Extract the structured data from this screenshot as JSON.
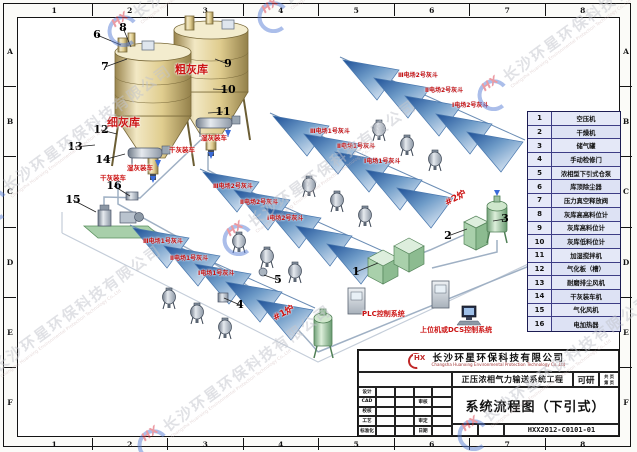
{
  "frame": {
    "top_zones": [
      "1",
      "2",
      "3",
      "4",
      "5",
      "6",
      "7",
      "8"
    ],
    "bottom_zones": [
      "1",
      "2",
      "3",
      "4",
      "5",
      "6",
      "7",
      "8"
    ],
    "left_zones": [
      "A",
      "B",
      "C",
      "D",
      "E",
      "F"
    ],
    "right_zones": [
      "A",
      "B",
      "C",
      "D",
      "E",
      "F"
    ]
  },
  "legend": {
    "rows": [
      {
        "no": "1",
        "name": "空压机"
      },
      {
        "no": "2",
        "name": "干燥机"
      },
      {
        "no": "3",
        "name": "储气罐"
      },
      {
        "no": "4",
        "name": "手动检修门"
      },
      {
        "no": "5",
        "name": "浓相型下引式仓泵"
      },
      {
        "no": "6",
        "name": "库顶除尘器"
      },
      {
        "no": "7",
        "name": "压力真空释放阀"
      },
      {
        "no": "8",
        "name": "灰库高高料位计"
      },
      {
        "no": "9",
        "name": "灰库高料位计"
      },
      {
        "no": "10",
        "name": "灰库低料位计"
      },
      {
        "no": "11",
        "name": "加湿搅拌机"
      },
      {
        "no": "12",
        "name": "气化板（槽）"
      },
      {
        "no": "13",
        "name": "耐磨排尘风机"
      },
      {
        "no": "14",
        "name": "干灰装车机"
      },
      {
        "no": "15",
        "name": "气化风机"
      },
      {
        "no": "16",
        "name": "电加热器"
      }
    ]
  },
  "title_block": {
    "logo_text": "HX",
    "company_cn": "长沙环星环保科技有限公司",
    "company_en": "Changsha Huanxing Environmental Protection Technology Co.,Ltd",
    "project": "正压浓相气力输送系统工程",
    "stage": "可研",
    "pages_total_label": "共  页",
    "pages_no_label": "第  页",
    "drawing_title": "系统流程图（下引式）",
    "drawing_no": "HXX2012-C0101-01",
    "fields_left": [
      "设计",
      "CAD",
      "校核",
      "工艺",
      "标准化"
    ],
    "fields_mid": [
      "",
      "审核",
      "",
      "审定",
      "日期"
    ]
  },
  "diagram": {
    "red_labels": [
      {
        "text": "细灰库",
        "x": 107,
        "y": 114,
        "size": 11,
        "rot": 0
      },
      {
        "text": "粗灰库",
        "x": 175,
        "y": 61,
        "size": 11,
        "rot": 0
      },
      {
        "text": "湿灰装车",
        "x": 201,
        "y": 132,
        "size": 6.5,
        "rot": 0
      },
      {
        "text": "干灰装车",
        "x": 169,
        "y": 144,
        "size": 6.5,
        "rot": 0
      },
      {
        "text": "湿灰装车",
        "x": 127,
        "y": 162,
        "size": 6.5,
        "rot": 0
      },
      {
        "text": "干灰装车",
        "x": 100,
        "y": 172,
        "size": 6.5,
        "rot": 0
      },
      {
        "text": "#1炉",
        "x": 270,
        "y": 312,
        "size": 9,
        "rot": -28
      },
      {
        "text": "#2炉",
        "x": 442,
        "y": 197,
        "size": 9,
        "rot": -28
      },
      {
        "text": "PLC控制系统",
        "x": 362,
        "y": 309,
        "size": 7,
        "rot": 0
      },
      {
        "text": "上位机或DCS控制系统",
        "x": 420,
        "y": 325,
        "size": 7,
        "rot": 0
      }
    ],
    "hopper_labels": [
      {
        "text": "Ⅲ电场1号灰斗",
        "x": 143,
        "y": 236
      },
      {
        "text": "Ⅱ电场1号灰斗",
        "x": 170,
        "y": 253
      },
      {
        "text": "Ⅰ电场1号灰斗",
        "x": 198,
        "y": 268
      },
      {
        "text": "Ⅲ电场2号灰斗",
        "x": 213,
        "y": 181
      },
      {
        "text": "Ⅱ电场2号灰斗",
        "x": 240,
        "y": 197
      },
      {
        "text": "Ⅰ电场2号灰斗",
        "x": 267,
        "y": 213
      },
      {
        "text": "Ⅲ电场1号灰斗",
        "x": 310,
        "y": 126
      },
      {
        "text": "Ⅱ电场1号灰斗",
        "x": 337,
        "y": 141
      },
      {
        "text": "Ⅰ电场1号灰斗",
        "x": 364,
        "y": 156
      },
      {
        "text": "Ⅲ电场2号灰斗",
        "x": 398,
        "y": 70
      },
      {
        "text": "Ⅱ电场2号灰斗",
        "x": 425,
        "y": 85
      },
      {
        "text": "Ⅰ电场2号灰斗",
        "x": 452,
        "y": 100
      }
    ],
    "callouts": [
      {
        "no": "1",
        "x": 356,
        "y": 272,
        "tx": 378,
        "ty": 263
      },
      {
        "no": "2",
        "x": 448,
        "y": 236,
        "tx": 467,
        "ty": 229
      },
      {
        "no": "3",
        "x": 505,
        "y": 219,
        "tx": 493,
        "ty": 221
      },
      {
        "no": "4",
        "x": 240,
        "y": 305,
        "tx": 224,
        "ty": 298
      },
      {
        "no": "5",
        "x": 278,
        "y": 280,
        "tx": 264,
        "ty": 275
      },
      {
        "no": "6",
        "x": 97,
        "y": 35,
        "tx": 121,
        "ty": 45
      },
      {
        "no": "7",
        "x": 105,
        "y": 67,
        "tx": 127,
        "ty": 59
      },
      {
        "no": "8",
        "x": 123,
        "y": 28,
        "tx": 131,
        "ty": 47
      },
      {
        "no": "9",
        "x": 228,
        "y": 64,
        "tx": 215,
        "ty": 59
      },
      {
        "no": "10",
        "x": 228,
        "y": 90,
        "tx": 213,
        "ty": 89
      },
      {
        "no": "11",
        "x": 223,
        "y": 112,
        "tx": 208,
        "ty": 113
      },
      {
        "no": "12",
        "x": 101,
        "y": 130,
        "tx": 117,
        "ty": 134
      },
      {
        "no": "13",
        "x": 75,
        "y": 147,
        "tx": 95,
        "ty": 145
      },
      {
        "no": "14",
        "x": 103,
        "y": 160,
        "tx": 125,
        "ty": 154
      },
      {
        "no": "15",
        "x": 73,
        "y": 200,
        "tx": 96,
        "ty": 212
      },
      {
        "no": "16",
        "x": 114,
        "y": 186,
        "tx": 130,
        "ty": 196
      }
    ]
  },
  "watermark": {
    "logo": "HX",
    "cn": "长沙环星环保科技有限公司",
    "en": "Changsha Huanxing Environmental Protection Technology Co.,Ltd",
    "instances": [
      {
        "x": 100,
        "y": 26,
        "rot": -36
      },
      {
        "x": 250,
        "y": 12,
        "rot": -36
      },
      {
        "x": -30,
        "y": 200,
        "rot": -36
      },
      {
        "x": 215,
        "y": 235,
        "rot": -36
      },
      {
        "x": 470,
        "y": 90,
        "rot": -36
      },
      {
        "x": -40,
        "y": 380,
        "rot": -36
      },
      {
        "x": 130,
        "y": 440,
        "rot": -36
      },
      {
        "x": 450,
        "y": 430,
        "rot": -36
      }
    ]
  }
}
